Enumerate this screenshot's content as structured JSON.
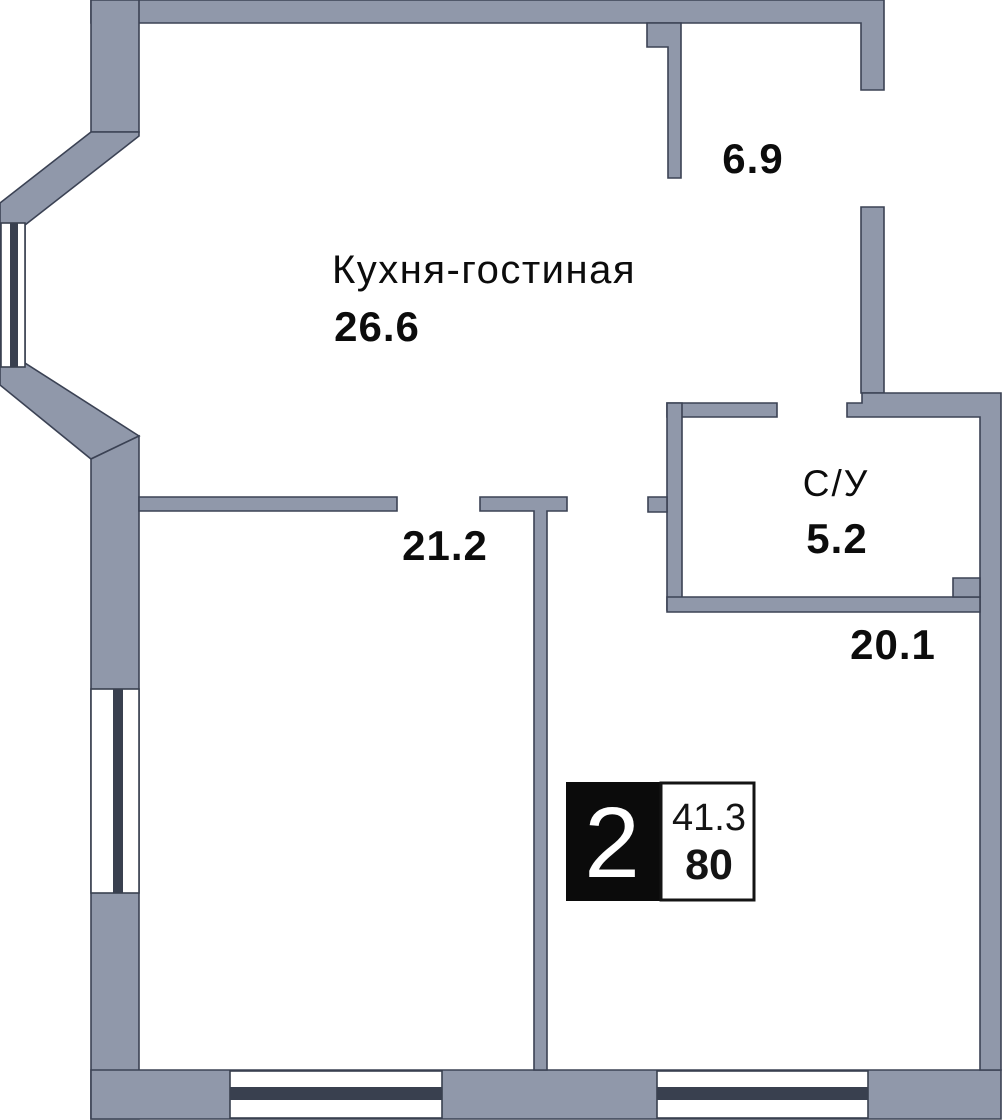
{
  "floor_plan": {
    "rooms": {
      "kitchen_living": {
        "name": "Кухня-гостиная",
        "area": "26.6"
      },
      "balcony": {
        "area": "6.9"
      },
      "bathroom": {
        "name": "С/У",
        "area": "5.2"
      },
      "room_left": {
        "area": "21.2"
      },
      "room_right": {
        "area": "20.1"
      }
    },
    "badge": {
      "room_count": "2",
      "area_top": "41.3",
      "area_bottom": "80"
    },
    "colors": {
      "wall_fill": "#9098aa",
      "wall_outline": "#3b4254",
      "window_glass": "#39404f",
      "badge_black": "#0b0b0b",
      "label_text": "#0c0c0c"
    }
  }
}
